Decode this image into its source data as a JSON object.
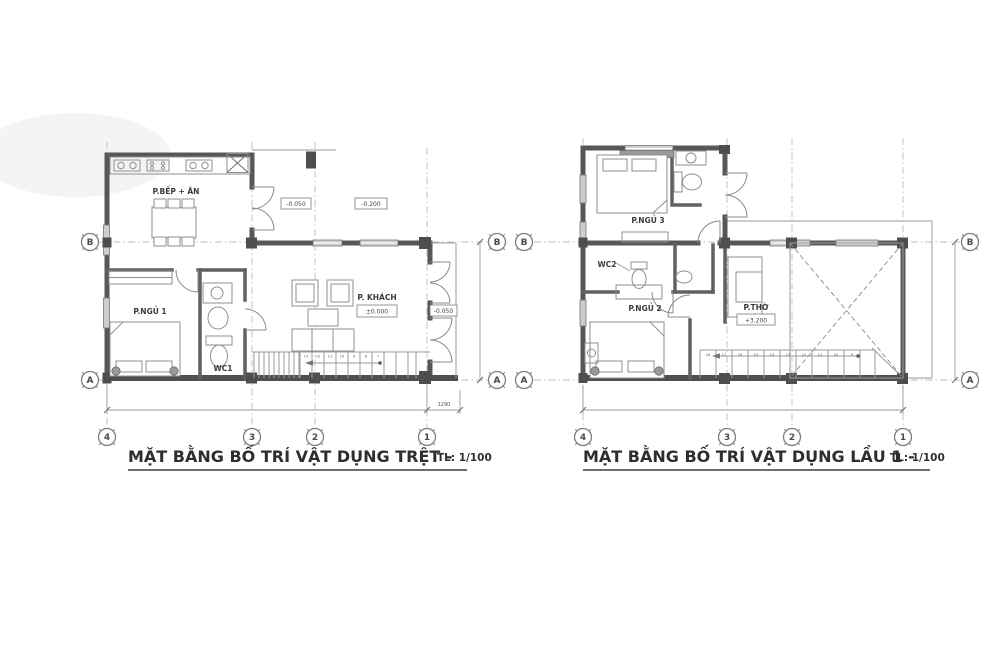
{
  "document": {
    "type": "architectural-floor-plans",
    "background": "#ffffff",
    "ink_color": "#575757",
    "grid_line_color": "#bdbdbd"
  },
  "plans": [
    {
      "id": "ground-floor",
      "title": "MẶT BẰNG BỐ TRÍ VẬT DỤNG TRỆT -",
      "scale": "TL: 1/100",
      "rooms": {
        "kitchen_dining": "P.BẾP + ĂN",
        "bedroom1": "P.NGỦ 1",
        "wc1": "WC1",
        "living": "P. KHÁCH"
      },
      "elevations": {
        "porch_step": "-0.050",
        "yard": "-0.200",
        "living": "±0.000",
        "side": "-0.050"
      },
      "axes": {
        "cols": [
          "4",
          "3",
          "2",
          "1"
        ],
        "rows": [
          "B",
          "A"
        ]
      },
      "dimensions": {
        "bottom_right": "1290"
      },
      "stairs": [
        "13",
        "12",
        "11",
        "10",
        "9",
        "8",
        "7"
      ]
    },
    {
      "id": "first-floor",
      "title": "MẶT BẰNG BỐ TRÍ VẬT DỤNG LẦU 1 -",
      "scale": "TL: 1/100",
      "rooms": {
        "bedroom3": "P.NGỦ 3",
        "wc2": "WC2",
        "bedroom2": "P.NGỦ 2",
        "worship": "P.THỜ"
      },
      "elevations": {
        "worship": "+3.200"
      },
      "axes": {
        "cols": [
          "4",
          "3",
          "2",
          "1"
        ],
        "rows": [
          "B",
          "A"
        ]
      },
      "stairs": [
        "18",
        "17",
        "16",
        "15",
        "14",
        "13",
        "12",
        "11",
        "10",
        "9"
      ]
    }
  ]
}
